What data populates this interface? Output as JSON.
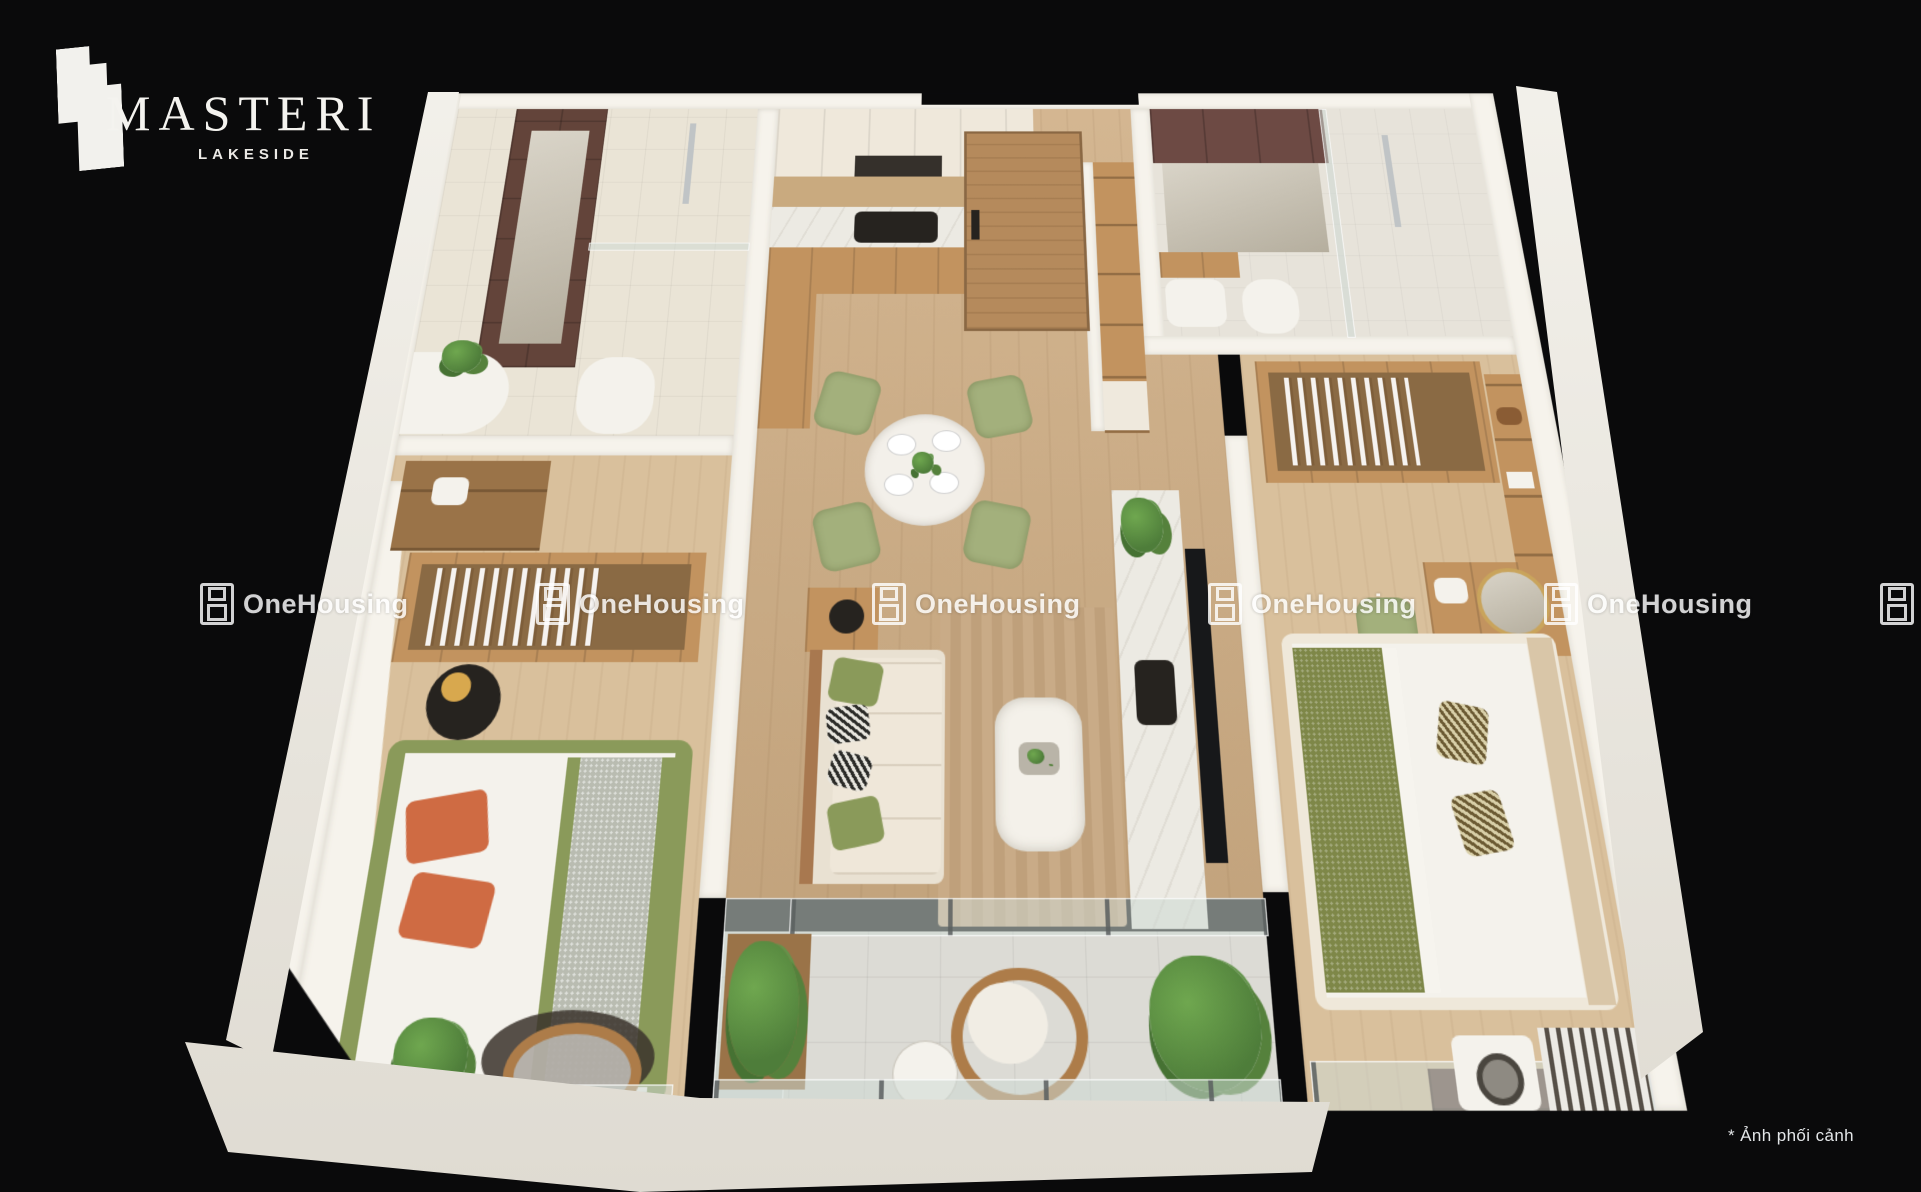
{
  "brand": {
    "name": "MASTERI",
    "subtitle": "LAKESIDE"
  },
  "watermark": {
    "label": "OneHousing",
    "icon": "onehousing-logo-icon",
    "count": 6
  },
  "caption": {
    "text": "* Ảnh phối cảnh"
  },
  "palette": {
    "background": "#0a0a0b",
    "wall": "#f6f3ec",
    "wood": "#cfae85",
    "wood_light": "#d9c09c",
    "cabinet": "#c2935f",
    "cabinet_dark": "#9a7348",
    "wood_door": "#b58a5c",
    "tile": "#eae4d6",
    "tile_cool": "#e7e3da",
    "balcony_tile": "#dcdbd5",
    "dark_brown": "#63443a",
    "maroon": "#6d4a44",
    "marble": "#eceae3",
    "green": "#8a9a5a",
    "sage": "#a3b07c",
    "olive": "#7e8748",
    "terracotta": "#cf6b43",
    "blanket_gray": "#b9bcb1",
    "plant": "#4e7d3a",
    "plant_light": "#6fa74f",
    "rattan": "#ad7c49",
    "dark": "#26231f",
    "white": "#f4f2ec",
    "glass": "rgba(206,216,212,0.55)"
  }
}
